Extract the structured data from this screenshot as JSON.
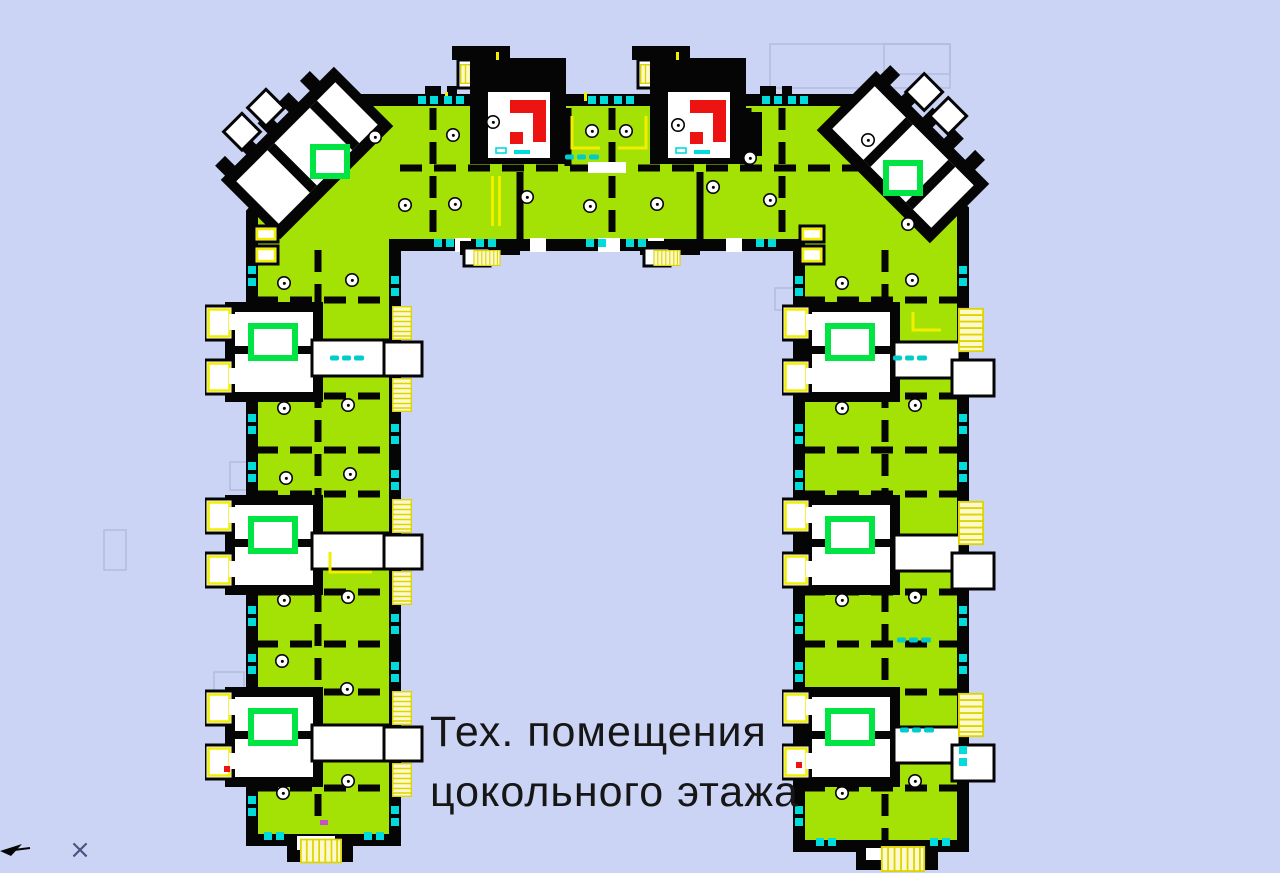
{
  "annotation": {
    "line1": "Тех. помещения",
    "line2": "цокольного этажа"
  },
  "cursor": {
    "mark": "×"
  },
  "plan": {
    "type": "architectural-floor-plan",
    "shape": "U-shaped (П) apartment building, basement level",
    "label_language": "Russian",
    "highlighted_rooms": "technical rooms filled green",
    "stairwell_modules": {
      "left_wing": 3,
      "right_wing": 3,
      "top_wing": 2,
      "corners": 2
    }
  },
  "colors": {
    "background": "#ccd4f6",
    "room_fill": "#a4e104",
    "wall": "#050505",
    "white": "#ffffff",
    "elevator_green": "#00e444",
    "accent_yellow": "#f2ee00",
    "stair_fill": "#fcf9cf",
    "stair_line": "#ded400",
    "stair_red": "#ee1313",
    "window_cyan": "#00dcdc",
    "label_cyan": "#00cccc",
    "text": "#161616",
    "cursor_gray": "#47547e",
    "magenta": "#c94fc9"
  }
}
